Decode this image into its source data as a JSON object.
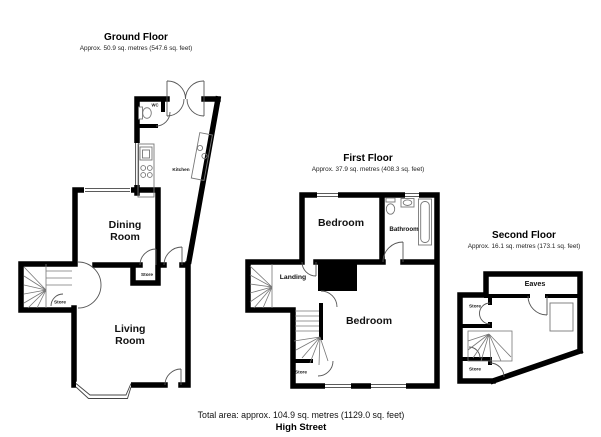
{
  "colors": {
    "background": "#ffffff",
    "walls": "#000000",
    "thin_lines": "#555555",
    "text": "#111111"
  },
  "floors": {
    "ground": {
      "title": "Ground Floor",
      "area": "Approx. 50.9 sq. metres (547.6 sq. feet)",
      "labels": {
        "wc": "WC",
        "kitchen": "Kitchen",
        "dining": [
          "Dining",
          "Room"
        ],
        "living": [
          "Living",
          "Room"
        ],
        "store_hall": "Store",
        "store_stairs": "Store"
      }
    },
    "first": {
      "title": "First Floor",
      "area": "Approx. 37.9 sq. metres (408.3 sq. feet)",
      "labels": {
        "bedroom_front": "Bedroom",
        "bathroom": "Bathroom",
        "landing": "Landing",
        "bedroom_back": "Bedroom",
        "store": "Store"
      }
    },
    "second": {
      "title": "Second Floor",
      "area": "Approx. 16.1 sq. metres (173.1 sq. feet)",
      "labels": {
        "eaves": "Eaves",
        "store_upper": "Store",
        "store_lower": "Store"
      }
    }
  },
  "footer": {
    "total_area": "Total area: approx. 104.9 sq. metres (1129.0 sq. feet)",
    "street": "High Street"
  }
}
